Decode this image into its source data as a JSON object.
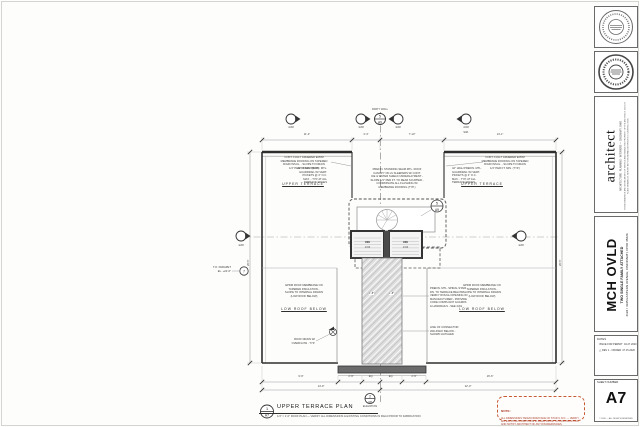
{
  "titleblock": {
    "firm": {
      "name": "architect",
      "address": "ARCHITECTURE · PLANNING · INTERIORS — CINCINNATI, OHIO",
      "disclaimer": "THESE DRAWINGS ARE INSTRUMENTS OF SERVICE AND REMAIN THE PROPERTY OF THE ARCHITECT. DO NOT SCALE DRAWINGS. REPORT ANY DISCREPANCIES PRIOR TO CONSTRUCTION."
    },
    "project": {
      "name": "MCH OVLD",
      "subtitle": "TWO SINGLE FAMILY ATTACHED",
      "address": "4193 / 4195 EASTERN AVENUE, CINCINNATI, OHIO 45226"
    },
    "dates": {
      "label": "DATES",
      "delta_icon": "△",
      "entries": [
        {
          "label": "ISSUE FOR PERMIT",
          "date": "04.27.2020"
        },
        {
          "label": "REV 1 - OWNER",
          "date": "07.15.2020"
        }
      ]
    },
    "sheet": {
      "label": "SHEET NUMBER",
      "number": "A7",
      "copyright": "© 2020 — ALL RIGHTS RESERVED"
    }
  },
  "drawing_title": {
    "title": "UPPER TERRACE PLAN",
    "scale_line": "1/4\" = 1'-0\"    ROOF PLAN — VERIFY ALL DIMENSIONS & EXISTING CONDITIONS IN FIELD PRIOR TO FABRICATION"
  },
  "note_box": {
    "heading": "NOTE:",
    "body": "ALL DIMENSIONS TAKEN FROM FACE OF STUD U.N.O. — VERIFY ALL EXISTING CONDITIONS IN FIELD PRIOR TO CONSTRUCTION AND NOTIFY ARCHITECT OF ANY DISCREPANCIES."
  },
  "bubbles": {
    "grid": {
      "top": "5",
      "bottom": "A9"
    },
    "detail": {
      "top": "5",
      "bottom": "A9"
    },
    "elevation": {
      "top": "2",
      "bottom": "A8",
      "label": "ELEVATION"
    },
    "title": {
      "top": "1",
      "bottom": "A7"
    },
    "parapet": {
      "top": "7"
    }
  },
  "markers": {
    "m1": "2/A8",
    "m2": "3/A8",
    "m3": "3/A8",
    "m4": "2/A8",
    "left": "4/A8",
    "right": "4/A8",
    "sim": "SIM."
  },
  "dims": {
    "top": [
      "11'-4\"",
      "3'-4\"",
      "7'-10\"",
      "14'-1\""
    ],
    "bottom_row1": [
      "9'-9\"",
      "2'-9\"",
      "EQ.",
      "EQ.",
      "2'-9\"",
      "16'-6\""
    ],
    "bottom_row2": [
      "14'-9\"",
      "22'-0\""
    ],
    "right_side": "26'-5\"",
    "left_side": "26'-5\"",
    "strip": [
      "1'-8\"",
      "1'-8\""
    ]
  },
  "notes": {
    "party_wall": "PARTY WALL",
    "left_roof": "CONT. FULLY ADHERED EPDM\nMEMBRANE ROOFING ON TAPERED\nRIGID INSUL. - SLOPE TO DRAIN\n1/4\" PER FT. MIN. (TYP.)",
    "rail_left": "42\" HIGH PREFIN. MTL.\nGUARDRAIL W/ VERT.\nPICKETS @ 4\" O.C.\nMAX. - TYP. AT ALL\nTERRACE EDGES",
    "canopy": "PREFIN. STANDING SEAM MTL. ROOF\nCANOPY ON 2x SLEEPERS W/ CONT.\nICE & WATER SHIELD UNDERLAYMENT -\nSLOPE 1/4\" PER FT. TO REAR SCUPPER -\nCOORDINATE ALL FLASHING W/\nMEMBRANE ROOFING (TYP.)",
    "rail_right": "42\" HIGH PREFIN. MTL.\nGUARDRAIL W/ VERT.\nPICKETS @ 4\" O.C.\nMAX. - TYP. AT ALL\nTERRACE EDGES",
    "right_roof": "CONT. FULLY ADHERED EPDM\nMEMBRANE ROOFING ON TAPERED\nRIGID INSUL. - SLOPE TO DRAIN\n1/4\" PER FT. MIN. (TYP.)",
    "terrace_left": "UPPER TERRACE",
    "terrace_right": "UPPER TERRACE",
    "dn": "DN",
    "risers": "13 R",
    "spiral": "PREFIN. MTL. SPIRAL STAIR\nDN. TO TERRACE BELOW -\nVERIFY ROUGH OPENING W/\nMANUFACTURER - PROVIDE\nCODE COMPLIANT GUARDS\n& HANDRAILS - SEE 4/A9",
    "walkway": "LINE OF CONNECTOR\nWALKWAY BELOW -\nSHOWN HATCHED",
    "roof_low_left": "EPDM ROOF MEMBRANE ON\nTAPERED INSULATION -\nSLOPE TO INTERNAL DRAINS\n(LOW ROOF BELOW)",
    "roof_low_right": "EPDM ROOF MEMBRANE ON\nTAPERED INSULATION -\nSLOPE TO INTERNAL DRAINS\n(LOW ROOF BELOW)",
    "roof_low_label_left": "LOW ROOF BELOW",
    "roof_low_label_right": "LOW ROOF BELOW",
    "drain": "ROOF DRAIN W/\nOVERFLOW - TYP.",
    "parapet": "T.O. PARAPET\nEL. +24'-6\""
  }
}
